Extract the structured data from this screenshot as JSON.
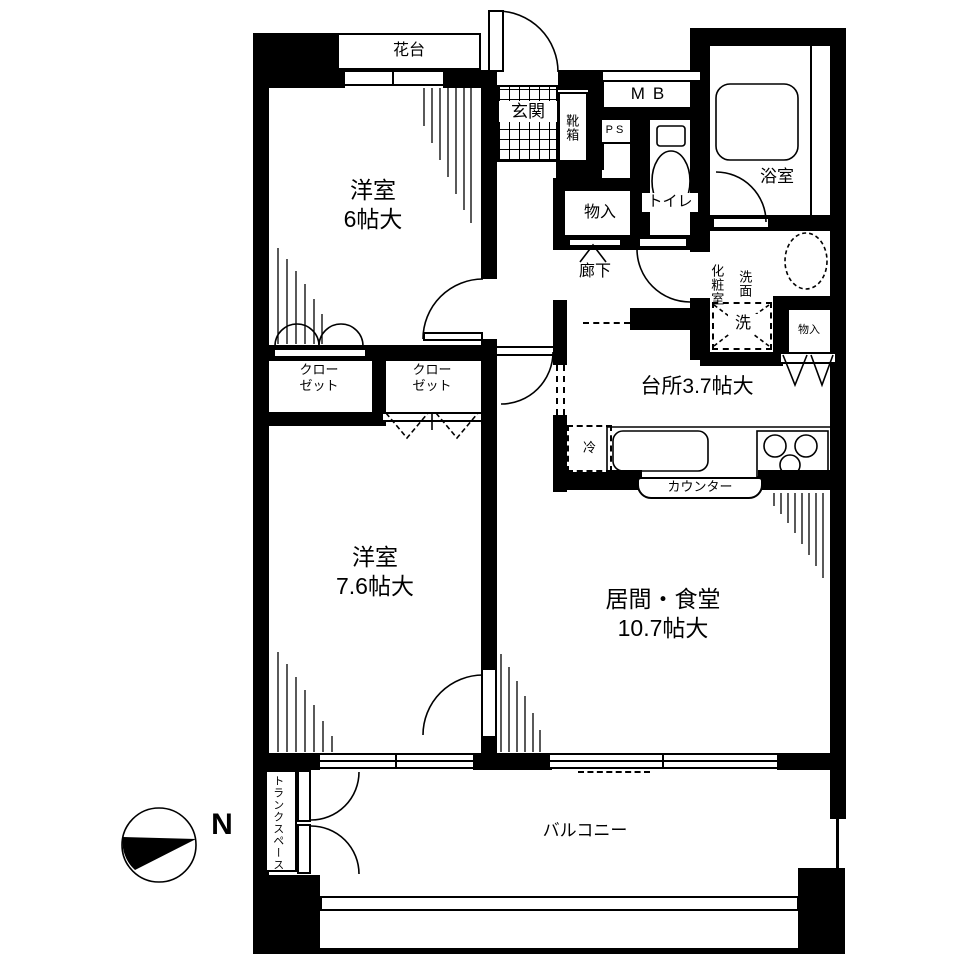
{
  "plan": {
    "rooms": {
      "bedroom6": {
        "name": "洋室",
        "size": "6帖大"
      },
      "bedroom76": {
        "name": "洋室",
        "size": "7.6帖大"
      },
      "living": {
        "name": "居間・食堂",
        "size": "10.7帖大"
      },
      "kitchen": {
        "label": "台所3.7帖大"
      },
      "bath": {
        "label": "浴室"
      },
      "toilet": {
        "label": "トイレ"
      },
      "powder_room": {
        "label": "化粧室",
        "washstand": "洗面"
      },
      "entrance": {
        "label": "玄関",
        "shoe_box": "靴箱"
      },
      "hallway": {
        "label": "廊下"
      },
      "balcony": {
        "label": "バルコニー"
      },
      "flower_stand": {
        "label": "花台"
      },
      "trunk_space": {
        "label": "トランクスペース"
      }
    },
    "storage": {
      "closet1": {
        "line1": "クロー",
        "line2": "ゼット"
      },
      "closet2": {
        "line1": "クロー",
        "line2": "ゼット"
      },
      "hall_storage": {
        "label": "物入"
      },
      "wash_storage": {
        "label": "物入"
      }
    },
    "fixtures": {
      "washer": "洗",
      "fridge": "冷",
      "counter": "カウンター",
      "meter_box": "MB",
      "pipe_space": "PS"
    },
    "compass": {
      "north": "N"
    }
  }
}
